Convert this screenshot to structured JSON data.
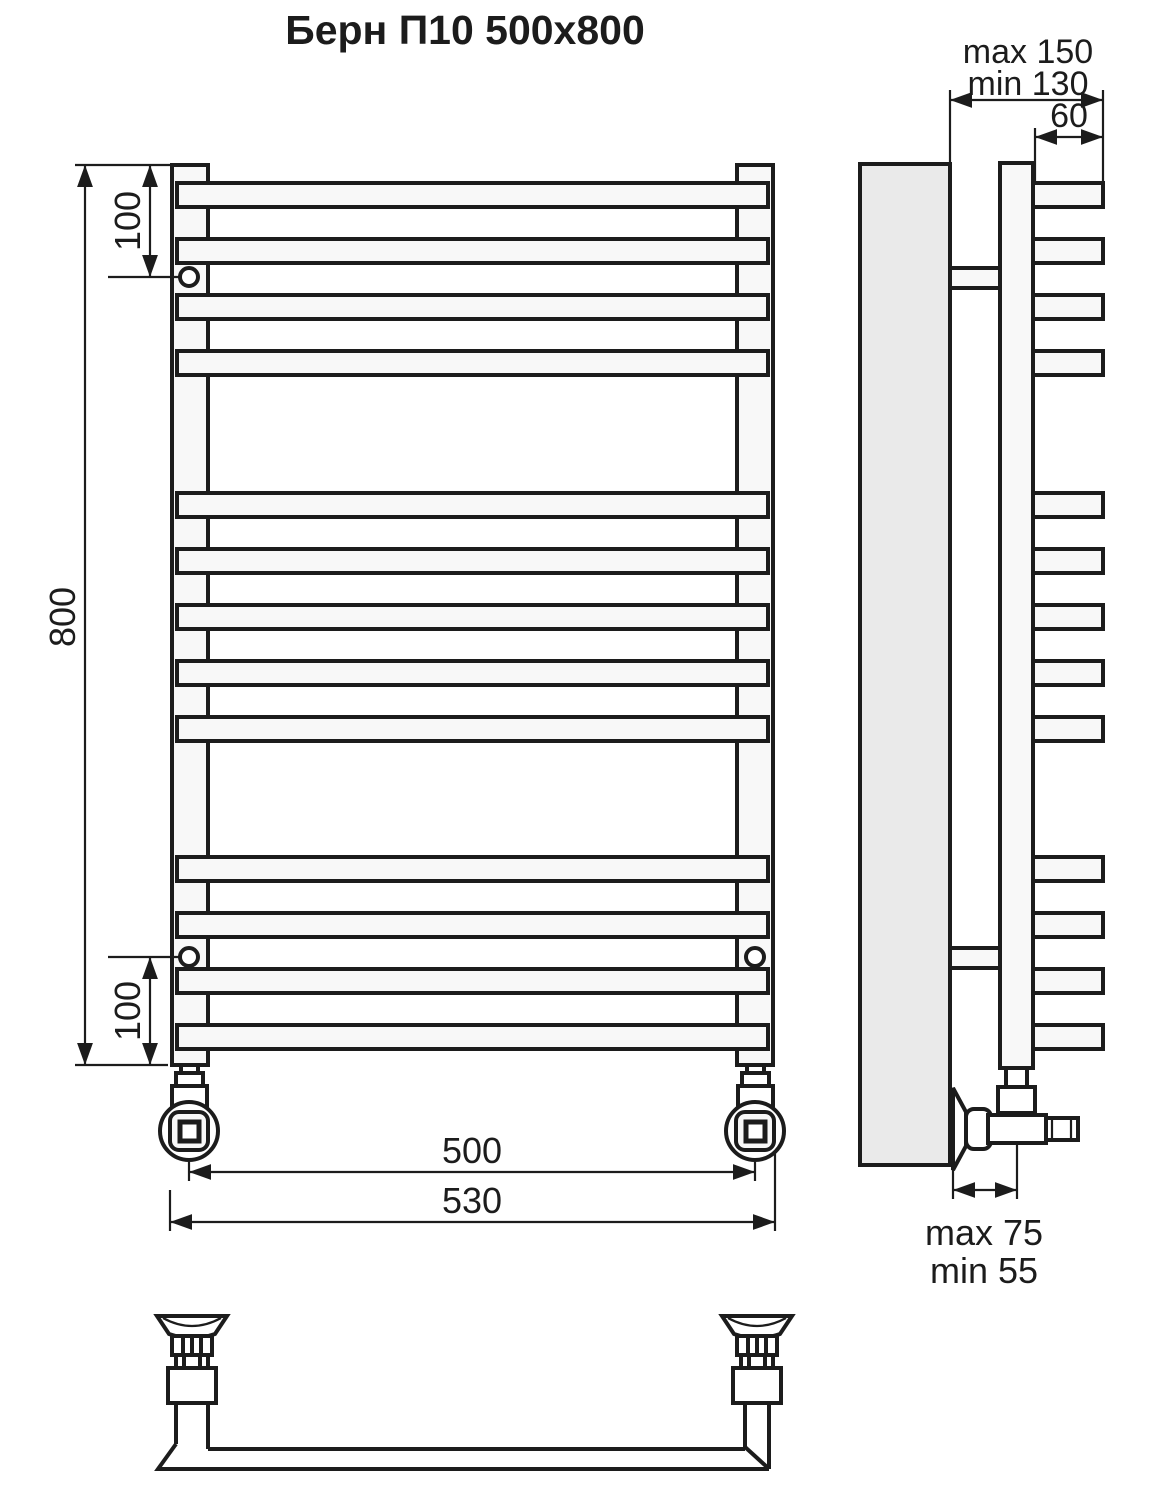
{
  "title": "Берн П10 500x800",
  "front_view": {
    "name": "front view of ladder towel rail",
    "rung_count": 13,
    "rung_groups": [
      4,
      5,
      4
    ],
    "dims": {
      "top_bracket_offset": "100",
      "height": "800",
      "bottom_bracket_offset": "100",
      "connection_spacing": "500",
      "overall_width": "530"
    }
  },
  "side_view": {
    "name": "side view with wall mounting",
    "dims": {
      "wall_distance_max": "max 150",
      "wall_distance_min": "min 130",
      "rung_depth": "60",
      "valve_offset_max": "max 75",
      "valve_offset_min": "min 55"
    }
  },
  "bottom_view": {
    "name": "bottom perspective view of lower rung with wall fittings"
  },
  "colors": {
    "line": "#1c1c1c",
    "wall_fill": "#eaeaea",
    "metal_fill": "#f8f8f8",
    "background": "#ffffff"
  }
}
